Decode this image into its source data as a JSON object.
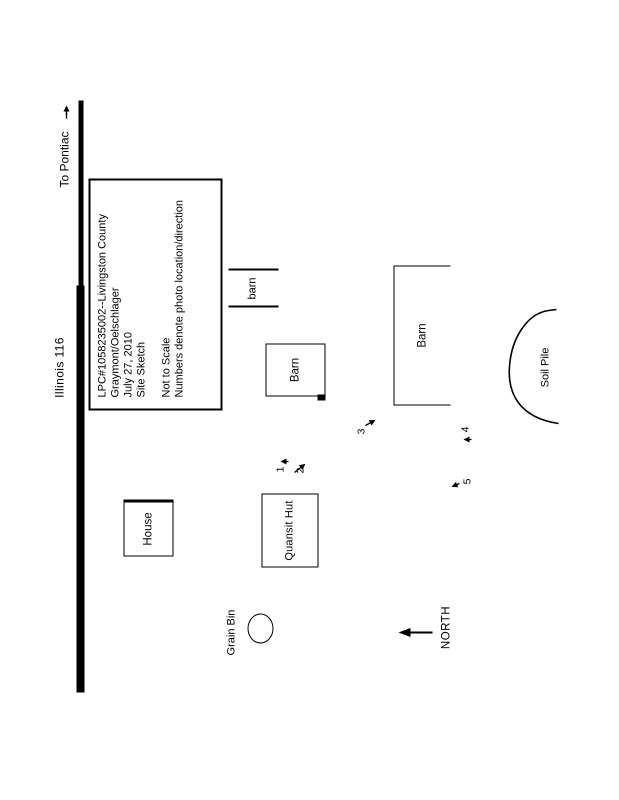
{
  "colors": {
    "ink": "#000000",
    "paper": "#ffffff"
  },
  "road": {
    "name_label": "Illinois 116",
    "direction_label": "To Pontiac"
  },
  "north": {
    "label": "NORTH"
  },
  "info_box": {
    "line1": "LPC#1058235002--Livingston County",
    "line2": "Graymont/Oelschlager",
    "line3": "July 27, 2010",
    "line4": "Site Sketch",
    "note1": "Not to Scale",
    "note2": "Numbers denote photo location/direction"
  },
  "structures": {
    "attached_barn": "barn",
    "barn_small": "Barn",
    "barn_large": "Barn",
    "house": "House",
    "quonset_hut": "Quansit Hut",
    "grain_bin": "Grain Bin",
    "soil_pile": "Soil Pile"
  },
  "photo_markers": {
    "m1": "1",
    "m2": "2",
    "m3": "3",
    "m4": "4",
    "m5": "5"
  }
}
